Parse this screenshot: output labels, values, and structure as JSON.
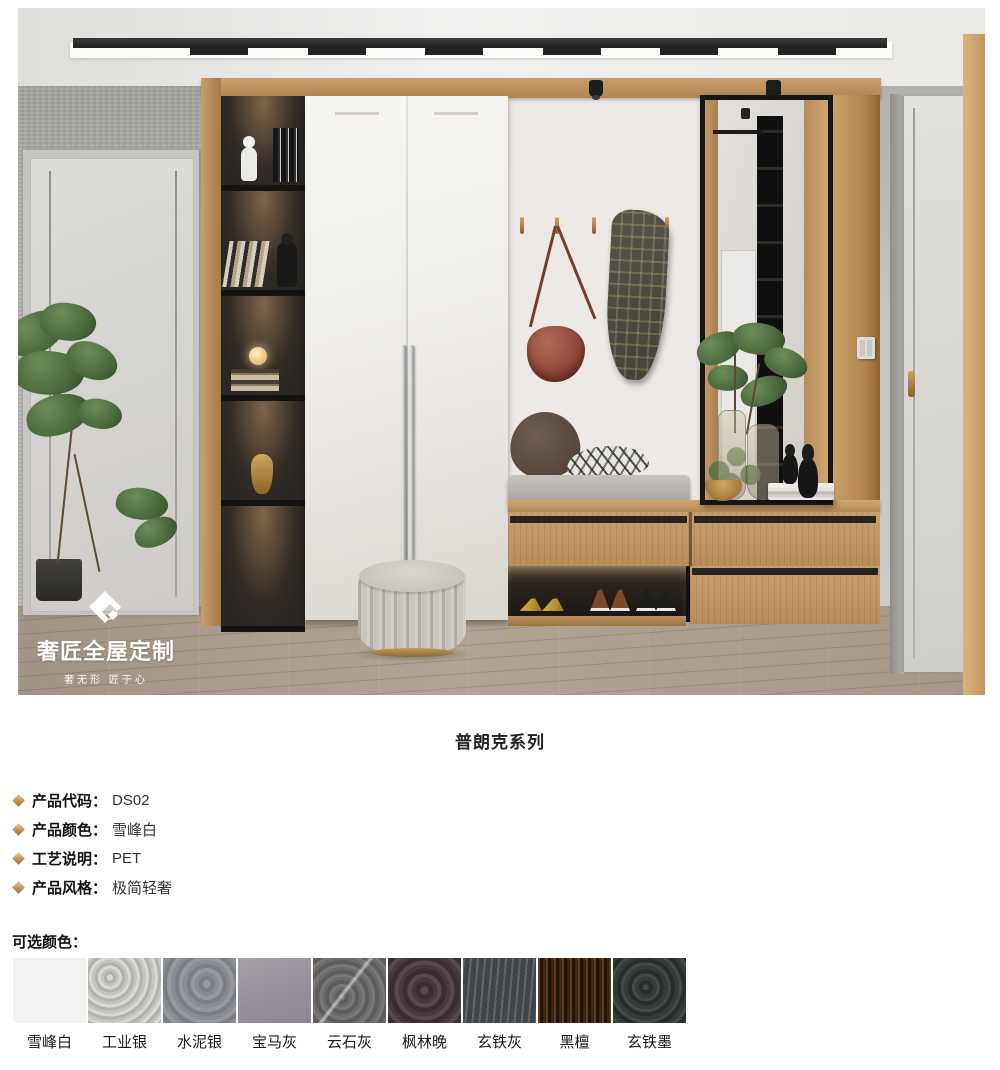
{
  "photo": {
    "watermark": {
      "brand": "奢匠全屋定制",
      "tagline": "奢无形 匠于心"
    }
  },
  "series_title": "普朗克系列",
  "specs": [
    {
      "label": "产品代码：",
      "value": "DS02"
    },
    {
      "label": "产品颜色：",
      "value": "雪峰白"
    },
    {
      "label": "工艺说明：",
      "value": "PET"
    },
    {
      "label": "产品风格：",
      "value": "极简轻奢"
    }
  ],
  "colors_section": {
    "heading": "可选颜色：",
    "bullet_color": "#c08d4e",
    "swatches": [
      {
        "name": "雪峰白",
        "color": "#f3f3f1"
      },
      {
        "name": "工业银",
        "color": "#c2c4be"
      },
      {
        "name": "水泥银",
        "color": "#8a8c93"
      },
      {
        "name": "宝马灰",
        "color": "#97929b"
      },
      {
        "name": "云石灰",
        "color": "#6c6b69"
      },
      {
        "name": "枫林晚",
        "color": "#473a3d"
      },
      {
        "name": "玄铁灰",
        "color": "#50555a"
      },
      {
        "name": "黑檀",
        "color": "#2e2012"
      },
      {
        "name": "玄铁墨",
        "color": "#353b37"
      }
    ]
  }
}
